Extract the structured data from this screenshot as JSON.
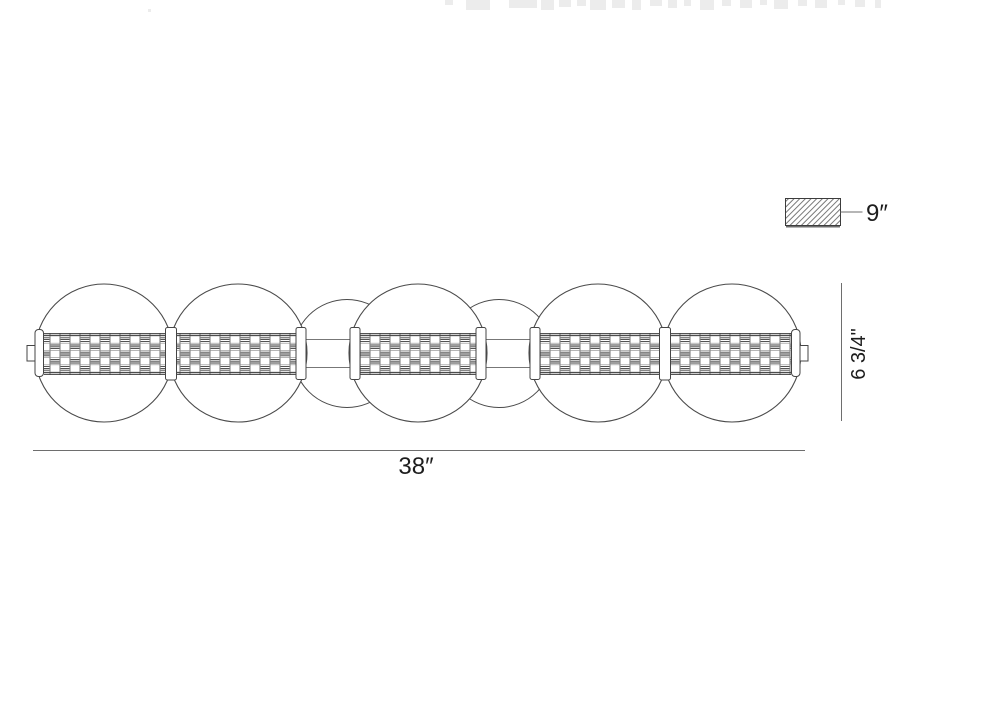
{
  "drawing": {
    "labels": {
      "width": "38″",
      "height": "6 3/4\"",
      "depth": "9″"
    },
    "colors": {
      "line": "#404040",
      "dimension_line": "#6e6e6e",
      "text": "#1d1d1d",
      "hatch": "#6a6a6a",
      "weave_dark": "#3c3c3c",
      "weave_light": "#8c8c8c",
      "background": "#ffffff"
    },
    "fixture": {
      "front_sphere_count": 5,
      "rear_sphere_count": 2
    }
  }
}
